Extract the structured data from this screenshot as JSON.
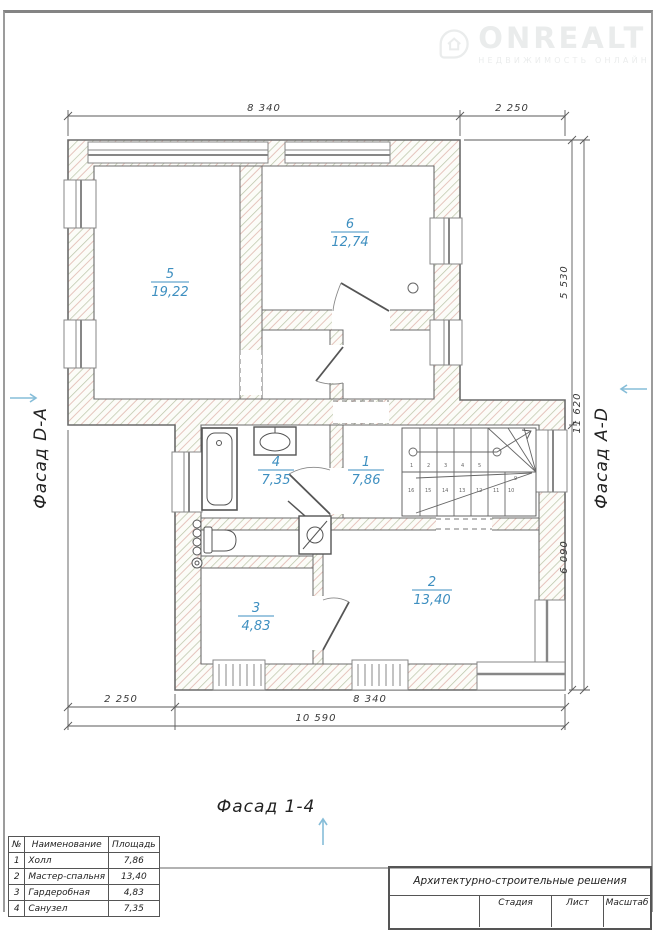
{
  "watermark": {
    "brand": "ONREALT",
    "tagline": "НЕДВИЖИМОСТЬ ОНЛАЙН"
  },
  "facades": {
    "left": "Фасад D-A",
    "right": "Фасад A-D",
    "bottom": "Фасад 1-4"
  },
  "dimensions": {
    "top_left": "8 340",
    "top_right": "2 250",
    "bottom_left": "2 250",
    "bottom_right": "8 340",
    "bottom_total": "10 590",
    "right_upper": "5 530",
    "right_lower": "6 090",
    "right_total": "11 620"
  },
  "rooms": [
    {
      "num": "1",
      "area": "7,86"
    },
    {
      "num": "2",
      "area": "13,40"
    },
    {
      "num": "3",
      "area": "4,83"
    },
    {
      "num": "4",
      "area": "7,35"
    },
    {
      "num": "5",
      "area": "19,22"
    },
    {
      "num": "6",
      "area": "12,74"
    }
  ],
  "stairs": {
    "treads": [
      "1",
      "2",
      "3",
      "4",
      "5",
      "6",
      "7",
      "8",
      "9",
      "10",
      "11",
      "12",
      "13",
      "14",
      "15",
      "16"
    ]
  },
  "legend_table": {
    "headers": [
      "№",
      "Наименование",
      "Площадь"
    ],
    "rows": [
      {
        "n": "1",
        "name": "Холл",
        "area": "7,86"
      },
      {
        "n": "2",
        "name": "Мастер-спальня",
        "area": "13,40"
      },
      {
        "n": "3",
        "name": "Гардеробная",
        "area": "4,83"
      },
      {
        "n": "4",
        "name": "Санузел",
        "area": "7,35"
      }
    ]
  },
  "title_block": {
    "title": "Архитектурно-строительные решения",
    "stage": "Стадия",
    "sheet": "Лист",
    "scale": "Масштаб"
  },
  "colors": {
    "label_blue": "#3e8fc0",
    "arrow_blue": "#86bdd8",
    "hatch_green": "#b9c3a6",
    "hatch_red": "#e0b6ae"
  }
}
